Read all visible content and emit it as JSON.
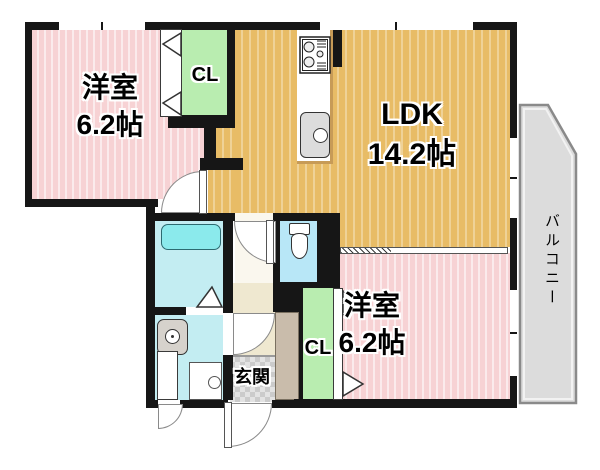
{
  "rooms": {
    "bedroom_top": {
      "name": "洋室",
      "area": "6.2帖"
    },
    "ldk": {
      "name": "LDK",
      "area": "14.2帖"
    },
    "bedroom_bottom": {
      "name": "洋室",
      "area": "6.2帖"
    },
    "closet_top": {
      "label": "CL"
    },
    "closet_bottom": {
      "label": "CL"
    },
    "entrance": {
      "label": "玄関"
    },
    "balcony": {
      "label": "バルコニー"
    }
  },
  "fixtures": [
    "bathtub",
    "washbasin",
    "washing-machine-pan",
    "toilet",
    "gas-stove",
    "kitchen-sink",
    "shoe-cabinet"
  ],
  "colors": {
    "wall": "#161616",
    "bedroom": "#f7d2d4",
    "ldk": "#e8bc66",
    "closet": "#b9edb0",
    "bath": "#c3edf2",
    "toilet": "#b8e7f7",
    "vestibule": "#faf7ee",
    "hallway": "#efe8d0",
    "balcony": "#dcdcdc",
    "cabinet": "#c9bcab",
    "counter_edge": "#c79b57",
    "tub": "#8beaec"
  }
}
